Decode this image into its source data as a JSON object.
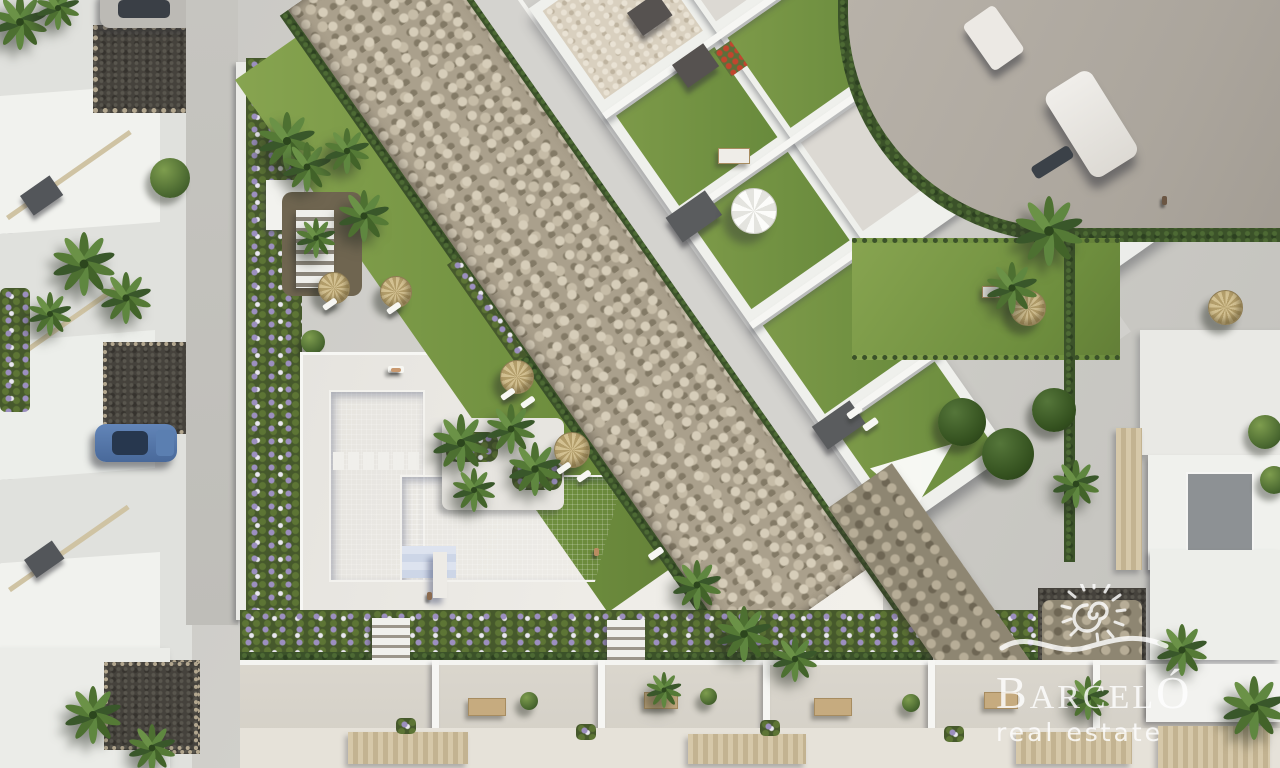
{
  "watermark": {
    "brand_full": "BARCELÓ",
    "brand_initial": "B",
    "brand_middle": "ARCEL",
    "brand_final": "Ó",
    "tagline": "real estate",
    "icon": "sun-spiral-wave-logo",
    "color": "#ffffff"
  },
  "palette": {
    "pavement": "#cac9c5",
    "sun_deck": "#eceae5",
    "street": "#c3c2bd",
    "road": "#b2aca3",
    "pool_water": "#c8d2e5",
    "lawn": "#7a9a47",
    "stone_riverbed": "#b3a892",
    "dark_gravel": "#45423c",
    "hedge": "#3b5229",
    "palm_frond": "#557534",
    "white_wall": "#f2f2ee",
    "gray_roof": "#8e9294",
    "straw_umbrella": "#c4b183",
    "purple_flowers": "#9c8fc0",
    "car_blue": "#5578ab",
    "van_white": "#eceae6"
  },
  "scene": {
    "type": "aerial-3d-architectural-render",
    "description": "Top-down render of a Mediterranean residential development: communal L-shaped pool with sun deck and palm island, landscaped dry stone riverbed crossing diagonally, apartment block with rooftop lawn terraces, rows of townhouses, hedge-lined street with parked cars and a white van, Barcelo real estate watermark at bottom right.",
    "features": [
      "L-shaped swimming pool",
      "sun deck with loungers",
      "palm island",
      "straw parasols",
      "white patio parasol",
      "shade sail",
      "rooftop lawn terraces",
      "dry stone riverbed",
      "hedge-lined street",
      "white van on curved road",
      "blue parked car",
      "townhouse terraces with dining sets",
      "stone retaining wall",
      "watermark logo"
    ]
  }
}
